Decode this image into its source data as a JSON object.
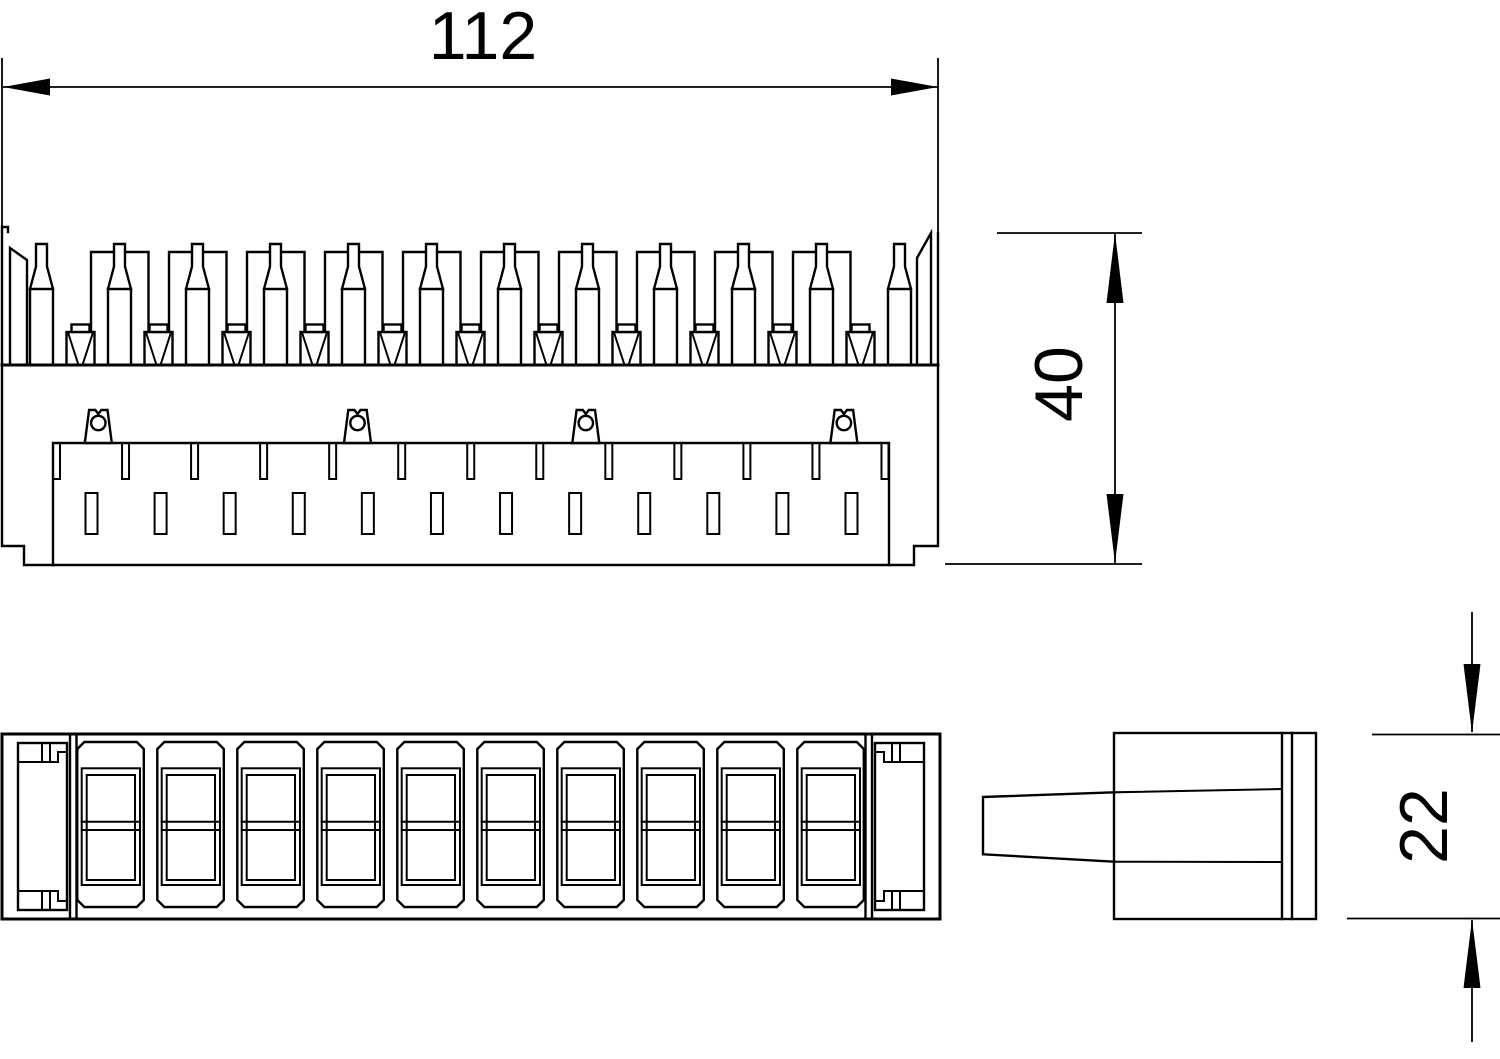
{
  "page": {
    "background": "#ffffff",
    "line_color": "#000000"
  },
  "dimensions": {
    "width_mm": "112",
    "height_mm": "40",
    "depth_mm": "22"
  },
  "front_view": {
    "bottle_pin_count": 12,
    "contact_block_count": 10,
    "wire_guide_count": 11,
    "top_slot_count": 13,
    "mid_slot_count": 12,
    "clip_centers_x": [
      98.3,
      357.5,
      585.8,
      843.9
    ]
  },
  "plan_view": {
    "module_count": 10
  }
}
